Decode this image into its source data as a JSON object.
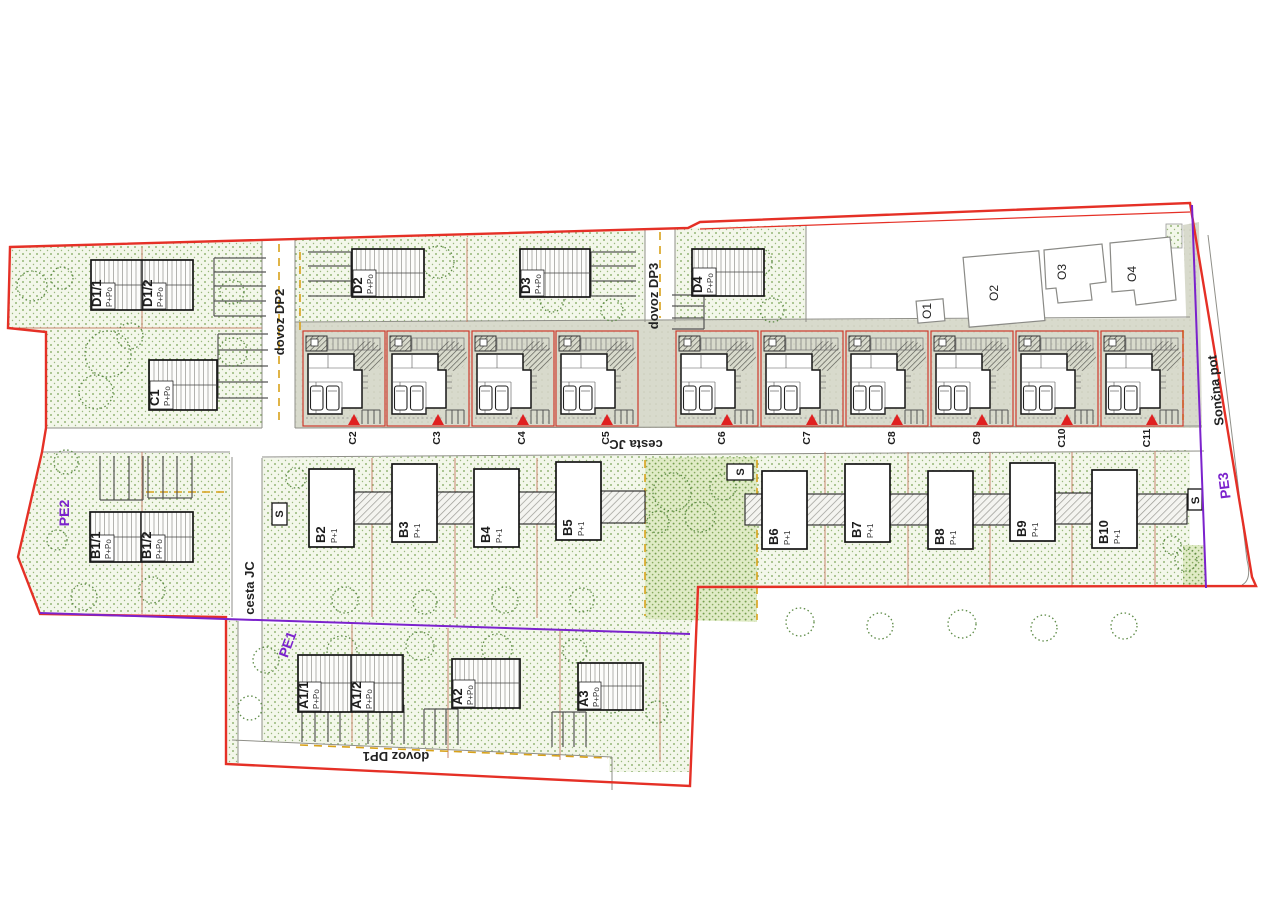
{
  "zones": {
    "pe1": "PE1",
    "pe2": "PE2",
    "pe3": "PE3"
  },
  "roads": {
    "cesta_jc": "cesta JC",
    "dovoz_dp1": "dovoz DP1",
    "dovoz_dp2": "dovoz DP2",
    "dovoz_dp3": "dovoz DP3",
    "soncna_pot": "Sončna pot"
  },
  "marker_s": "S",
  "houses": {
    "d_duplex": [
      {
        "label": "D1/1",
        "storeys": "P+Po"
      },
      {
        "label": "D1/2",
        "storeys": "P+Po"
      }
    ],
    "c1": {
      "label": "C1",
      "storeys": "P+Po"
    },
    "d_single": [
      {
        "label": "D2",
        "storeys": "P+Po"
      },
      {
        "label": "D3",
        "storeys": "P+Po"
      },
      {
        "label": "D4",
        "storeys": "P+Po"
      }
    ],
    "o_existing": [
      "O1",
      "O2",
      "O3",
      "O4"
    ],
    "c_row": [
      "C2",
      "C3",
      "C4",
      "C5",
      "C6",
      "C7",
      "C8",
      "C9",
      "C10",
      "C11"
    ],
    "b_duplex": [
      {
        "label": "B1/1",
        "storeys": "P+Po"
      },
      {
        "label": "B1/2",
        "storeys": "P+Po"
      }
    ],
    "b_row": [
      {
        "label": "B2",
        "storeys": "P+1"
      },
      {
        "label": "B3",
        "storeys": "P+1"
      },
      {
        "label": "B4",
        "storeys": "P+1"
      },
      {
        "label": "B5",
        "storeys": "P+1"
      },
      {
        "label": "B6",
        "storeys": "P+1"
      },
      {
        "label": "B7",
        "storeys": "P+1"
      },
      {
        "label": "B8",
        "storeys": "P+1"
      },
      {
        "label": "B9",
        "storeys": "P+1"
      },
      {
        "label": "B10",
        "storeys": "P+1"
      }
    ],
    "a_row": [
      {
        "label": "A1/1",
        "storeys": "P+Po"
      },
      {
        "label": "A1/2",
        "storeys": "P+Po"
      },
      {
        "label": "A2",
        "storeys": "P+Po"
      },
      {
        "label": "A3",
        "storeys": "P+Po"
      }
    ]
  },
  "colors": {
    "site_boundary": "#e53026",
    "zone_line": "#7b22cc",
    "building_line_dash": "#d8a21a",
    "parcel_line": "#c8856e",
    "green_dot": "#7aa455",
    "paved_strip": "#d9dbce"
  }
}
